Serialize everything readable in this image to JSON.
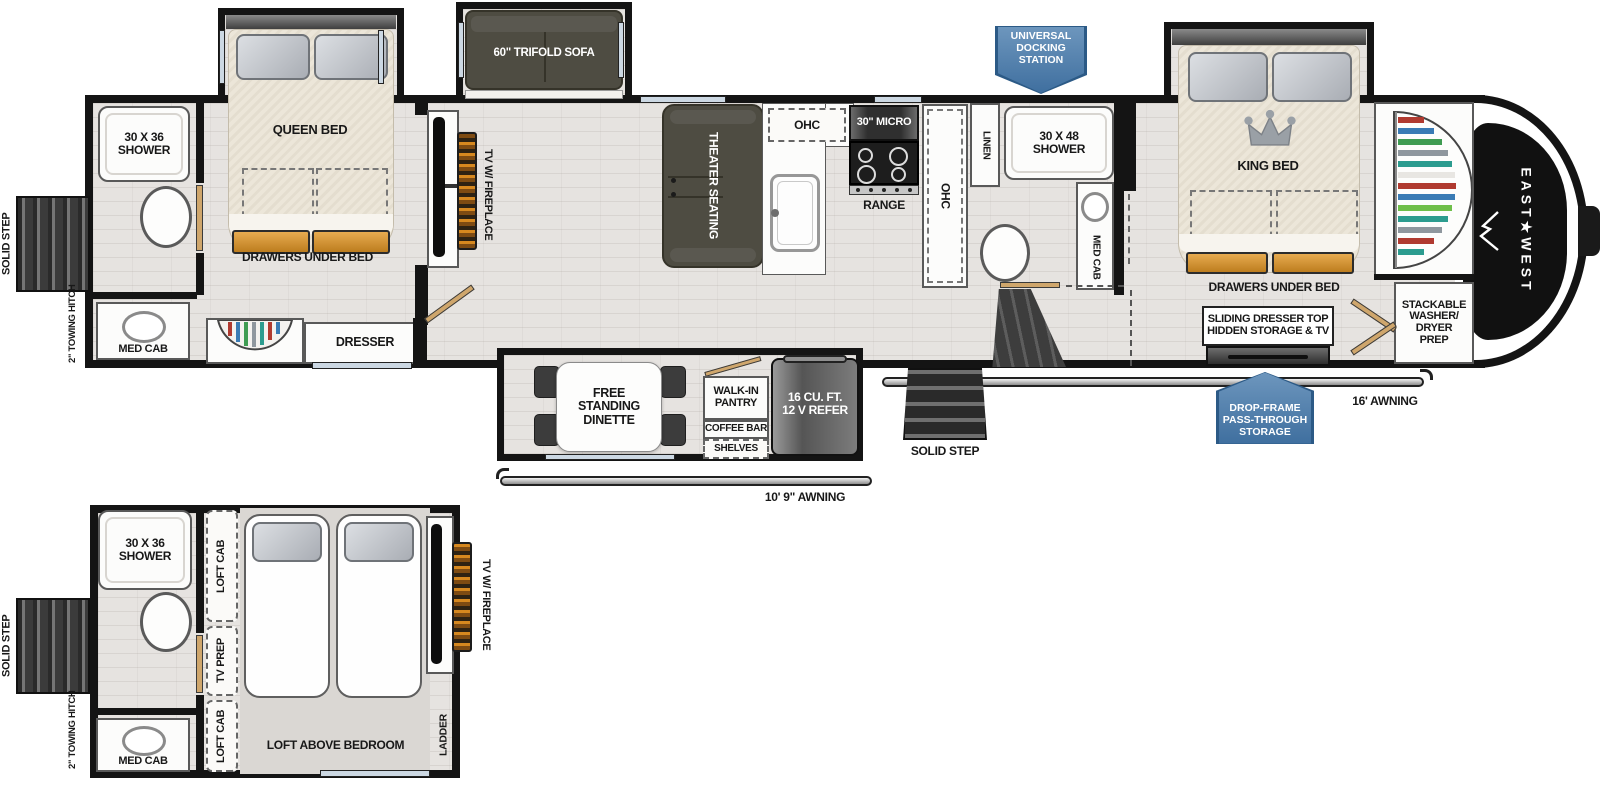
{
  "brand": {
    "logo_text": "EAST★WEST"
  },
  "badges": {
    "universal_docking": "UNIVERSAL\nDOCKING\nSTATION",
    "drop_frame": "DROP-FRAME\nPASS-THROUGH\nSTORAGE"
  },
  "labels": {
    "solid_step": "SOLID STEP",
    "towing_hitch": "2\" TOWING HITCH",
    "shower_30x36": "30 X 36\nSHOWER",
    "med_cab": "MED CAB",
    "queen_bed": "QUEEN BED",
    "drawers_under_bed": "DRAWERS UNDER BED",
    "dresser": "DRESSER",
    "trifold_sofa": "60\" TRIFOLD SOFA",
    "tv_fireplace": "TV W/ FIREPLACE",
    "theater_seating": "THEATER SEATING",
    "ohc": "OHC",
    "micro_30": "30\" MICRO",
    "range": "RANGE",
    "linen": "LINEN",
    "shower_30x48": "30 X 48\nSHOWER",
    "king_bed": "KING BED",
    "sliding_dresser": "SLIDING DRESSER TOP\nHIDDEN STORAGE & TV",
    "stackable_washer": "STACKABLE\nWASHER/\nDRYER\nPREP",
    "awning_16": "16' AWNING",
    "awning_10_9": "10' 9\" AWNING",
    "free_standing_dinette": "FREE\nSTANDING\nDINETTE",
    "walk_in_pantry": "WALK-IN\nPANTRY",
    "coffee_bar": "COFFEE BAR",
    "shelves": "SHELVES",
    "refer": "16 CU. FT.\n12 V REFER",
    "loft_cab": "LOFT CAB",
    "tv_prep": "TV PREP",
    "loft_above_bedroom": "LOFT ABOVE BEDROOM",
    "ladder": "LADDER"
  }
}
